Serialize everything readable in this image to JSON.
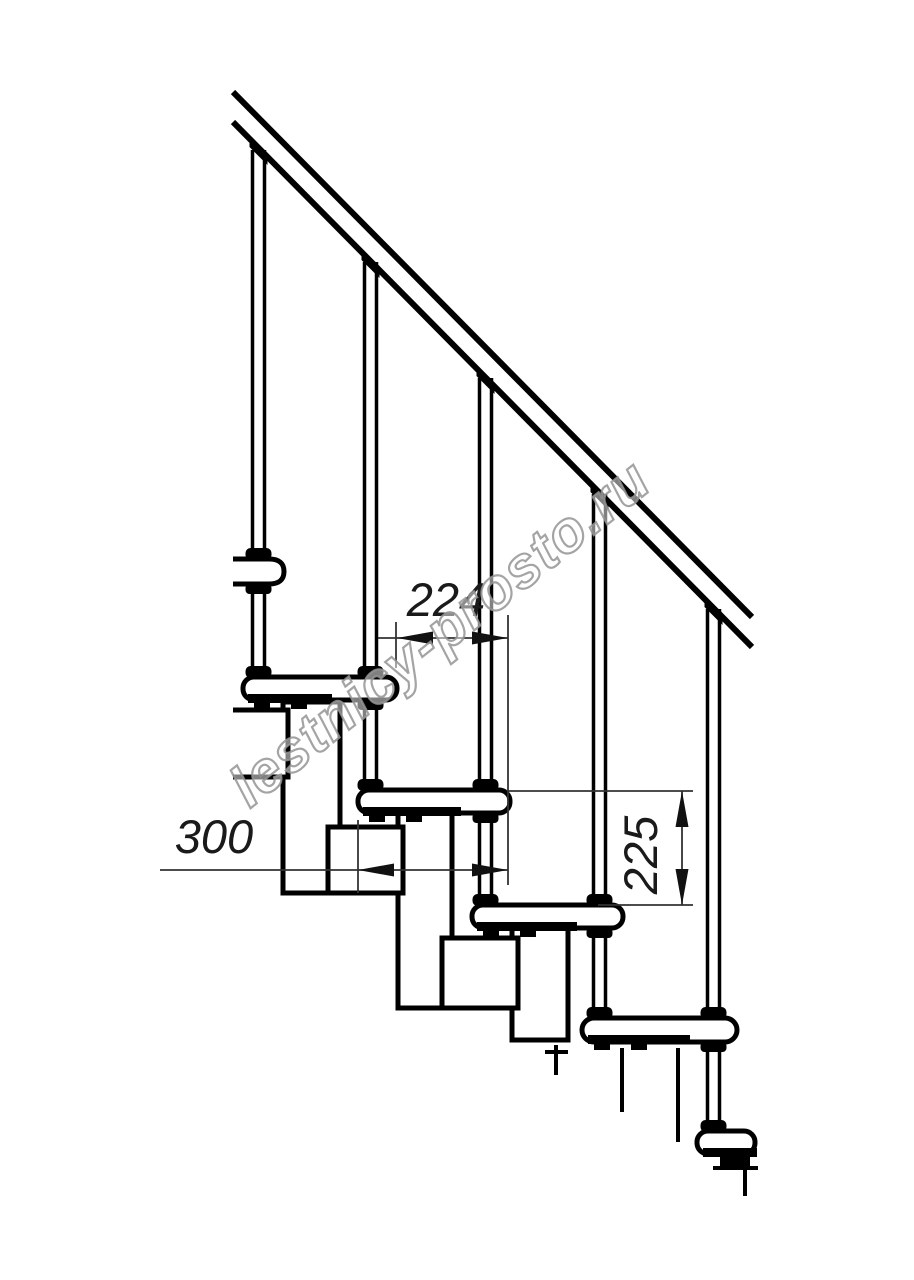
{
  "drawing": {
    "type": "staircase-side-view-technical-drawing",
    "watermark": "lestnicy-prosto.ru",
    "dimensions": {
      "tread_run": "224",
      "tread_depth": "300",
      "riser_height": "225"
    },
    "colors": {
      "line": "#000000",
      "dimension_line": "#333333",
      "watermark_outline": "#949494",
      "background": "#ffffff"
    }
  }
}
